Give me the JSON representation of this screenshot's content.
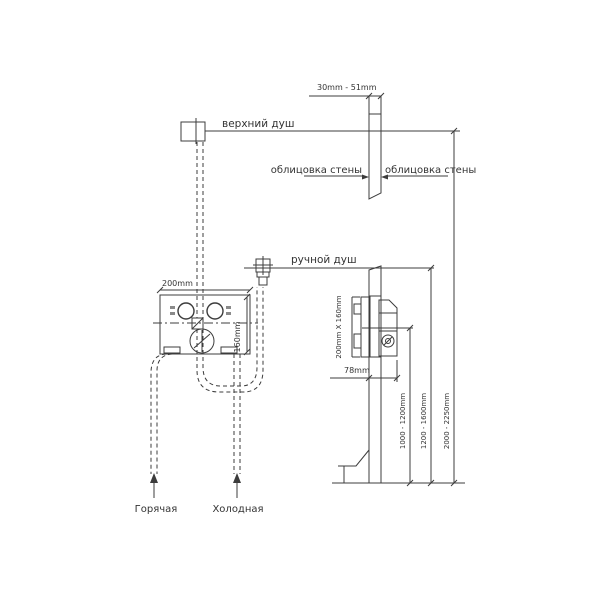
{
  "page": {
    "background": "#ffffff",
    "line_color": "#3c3c3c",
    "text_color": "#333333"
  },
  "labels": {
    "overhead_shower": "верхний душ",
    "hand_shower": "ручной душ",
    "wall_cladding_left": "облицовка стены",
    "wall_cladding_right": "облицовка стены",
    "hot_supply": "Горячая",
    "cold_supply": "Холодная"
  },
  "dimensions": {
    "cladding_thickness": "30mm - 51mm",
    "box_width": "200mm",
    "box_height": "160mm",
    "box_face_size": "200mm X 160mm",
    "installation_depth": "78mm",
    "mixer_height_range": "1000 - 1200mm",
    "hand_shower_height_range": "1200 - 1600mm",
    "overhead_shower_height_range": "2000 - 2250mm"
  }
}
